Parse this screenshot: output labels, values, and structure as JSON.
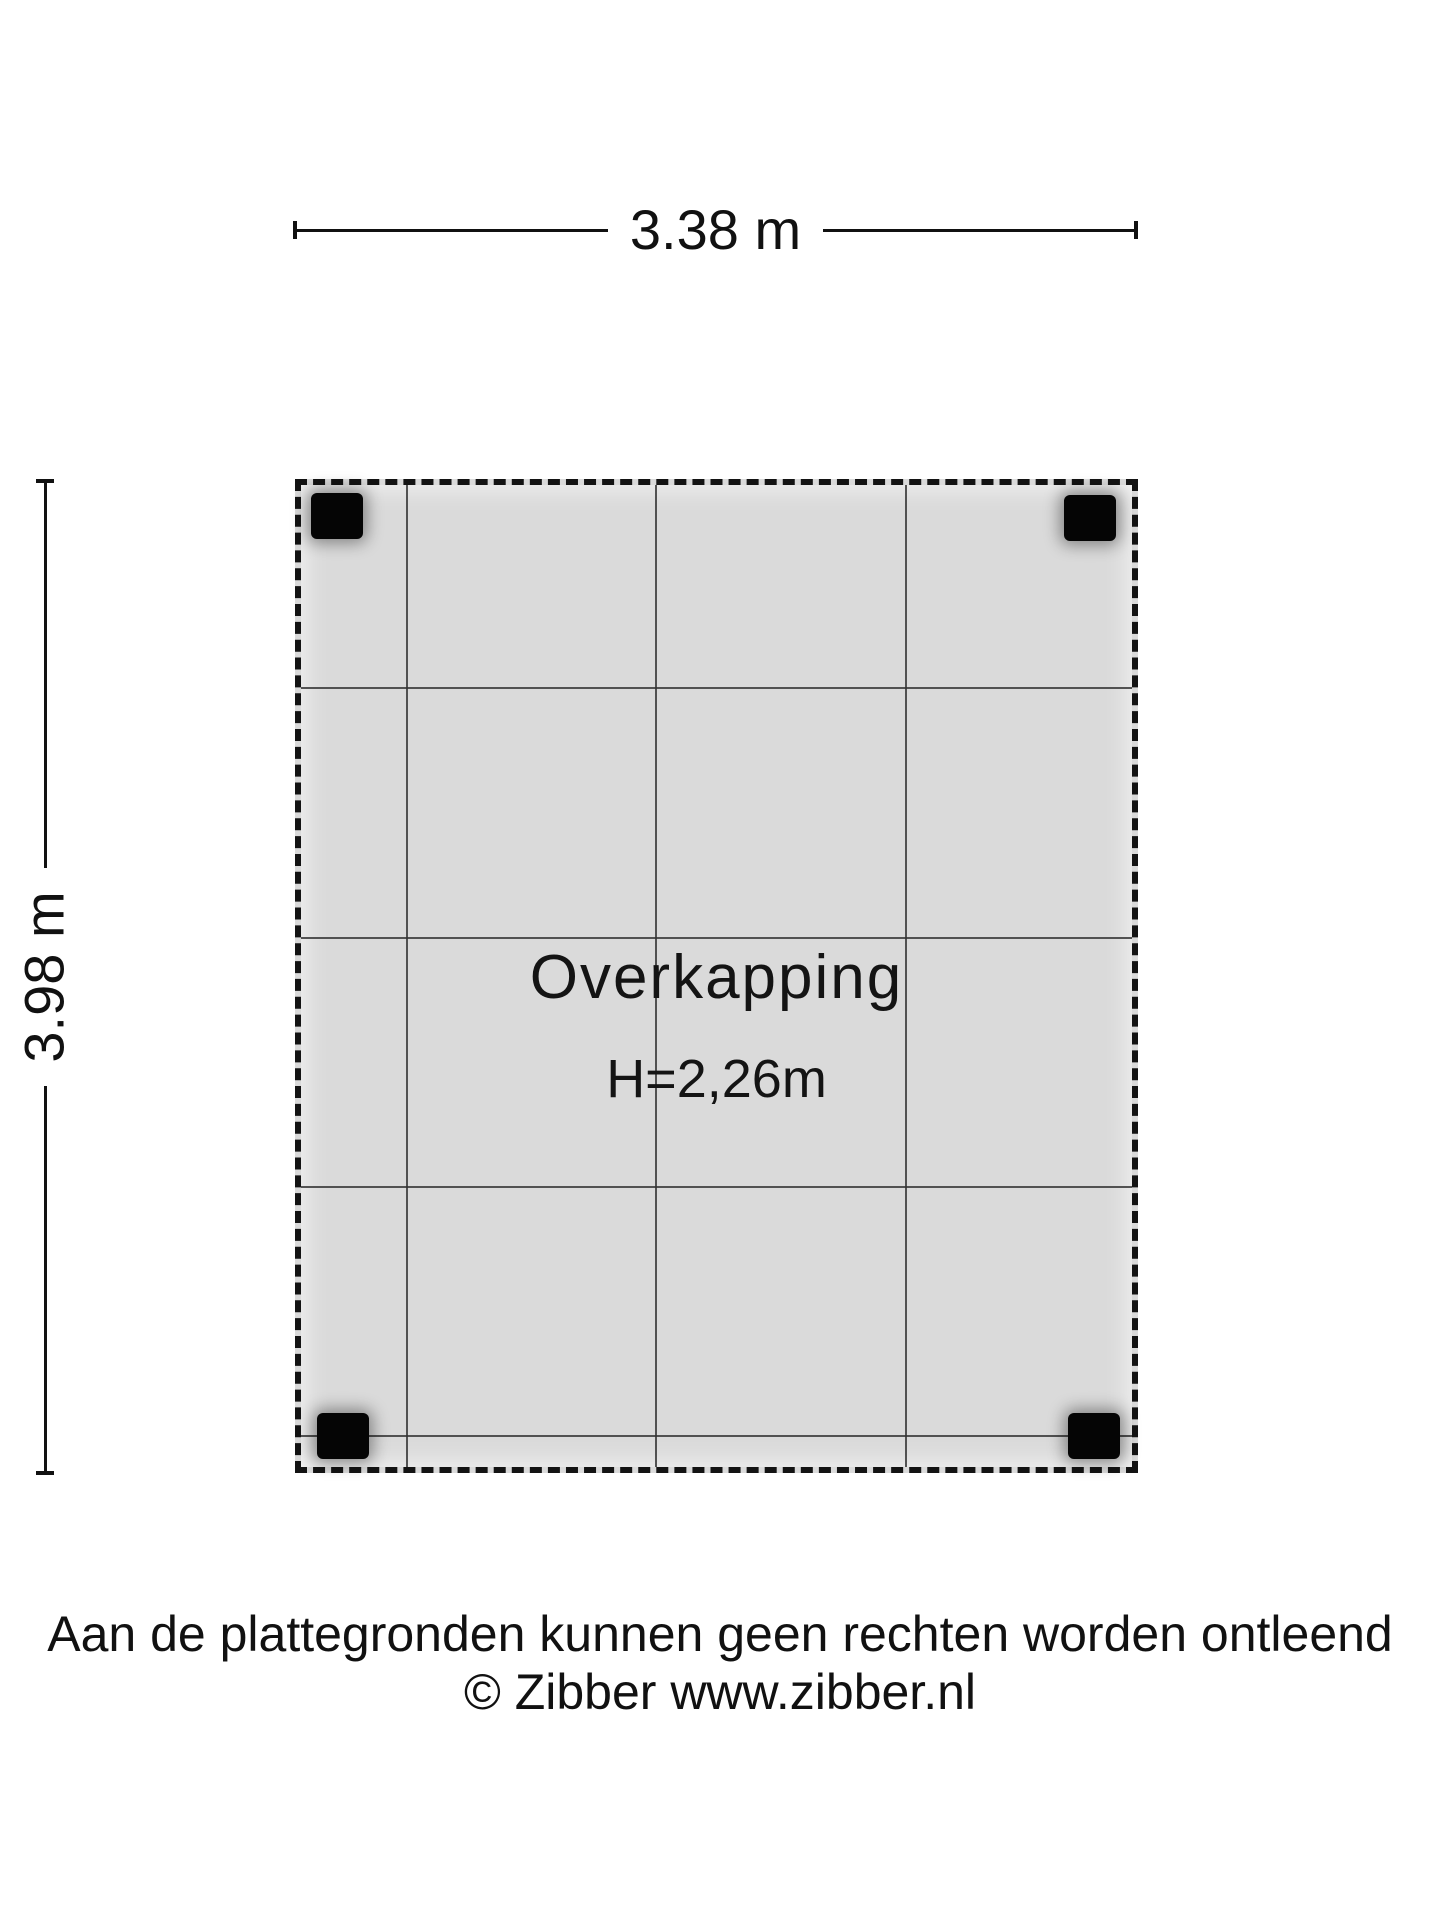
{
  "dimensions": {
    "width_label": "3.38 m",
    "height_label": "3.98 m"
  },
  "room": {
    "name": "Overkapping",
    "ceiling_height": "H=2,26m"
  },
  "footer": {
    "disclaimer": "Aan de plattegronden kunnen geen rechten worden ontleend",
    "copyright": "© Zibber www.zibber.nl"
  },
  "colors": {
    "background": "#ffffff",
    "floor_fill": "#dadada",
    "grid_line": "#323232",
    "outline_dashed": "#131313",
    "post": "#050505",
    "text": "#111111"
  },
  "grid": {
    "vertical_offsets_px": [
      105,
      354,
      604
    ],
    "horizontal_offsets_px": [
      202,
      452,
      701,
      950
    ]
  },
  "posts": [
    {
      "position": "top-left",
      "class": "tl"
    },
    {
      "position": "top-right",
      "class": "tr"
    },
    {
      "position": "bottom-left",
      "class": "bl"
    },
    {
      "position": "bottom-right",
      "class": "br"
    }
  ]
}
